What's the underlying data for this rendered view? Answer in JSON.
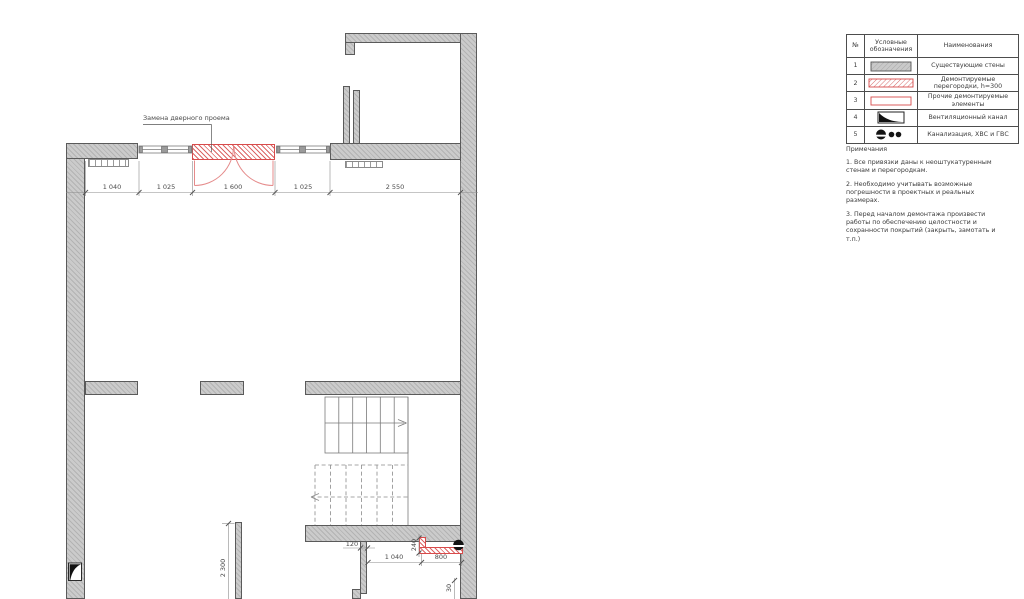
{
  "plan": {
    "callout_label": "Замена дверного проема",
    "dimensions": {
      "top_row": [
        "1 040",
        "1 025",
        "1 600",
        "1 025",
        "2 550"
      ],
      "room_height": "2 300",
      "partition_width": "120",
      "offset_240": "240",
      "bottom_1040": "1 040",
      "bottom_800": "800",
      "gap_30": "30"
    }
  },
  "legend": {
    "headers": {
      "num": "№",
      "symbol": "Условные обозначения",
      "name": "Наименования"
    },
    "rows": [
      {
        "num": "1",
        "symbol": "existing-wall-symbol",
        "name": "Существующие стены"
      },
      {
        "num": "2",
        "symbol": "demolished-partition-symbol",
        "name": "Демонтируемые перегородки, h=300"
      },
      {
        "num": "3",
        "symbol": "other-demolished-symbol",
        "name": "Прочие демонтируемые элементы"
      },
      {
        "num": "4",
        "symbol": "vent-channel-symbol",
        "name": "Вентиляционный канал"
      },
      {
        "num": "5",
        "symbol": "plumbing-symbol",
        "name": "Канализация, ХВС и ГВС"
      }
    ]
  },
  "notes": {
    "title": "Примечания",
    "items": [
      "1. Все привязки даны к неоштукатуренным стенам и перегородкам.",
      "2. Необходимо учитывать возможные погрешности в проектных и реальных размерах.",
      "3. Перед началом демонтажа произвести работы по обеспечению целостности и сохранности покрытий (закрыть, замотать и т.п.)"
    ]
  },
  "colors": {
    "wall_gray": "#cbcbcb",
    "demolition_red": "#d84b4b",
    "line": "#5a5a5a"
  }
}
